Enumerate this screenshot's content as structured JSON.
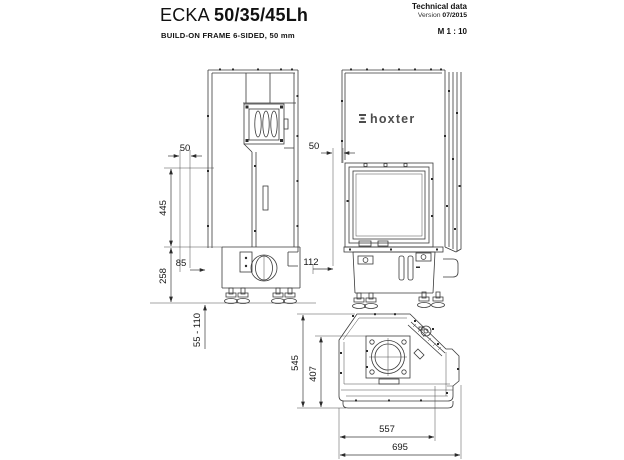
{
  "header": {
    "product": "ECKA",
    "variant": "50/35/45Lh",
    "subtitle": "BUILD-ON FRAME 6-SIDED, 50 mm",
    "doc_type": "Technical data",
    "version_label": "Version",
    "version_value": "07/2015",
    "scale": "M 1 : 10"
  },
  "logo": {
    "brand": "hoxter"
  },
  "dimensions": {
    "side_view": {
      "frame_depth": "50",
      "glass_height": "445",
      "base_height": "258",
      "offset": "85",
      "feet_range": "55 - 110"
    },
    "front_view": {
      "frame_width": "50",
      "offset": "112"
    },
    "top_view": {
      "total_depth": "545",
      "body_depth": "407",
      "body_width": "557",
      "total_width": "695"
    }
  }
}
